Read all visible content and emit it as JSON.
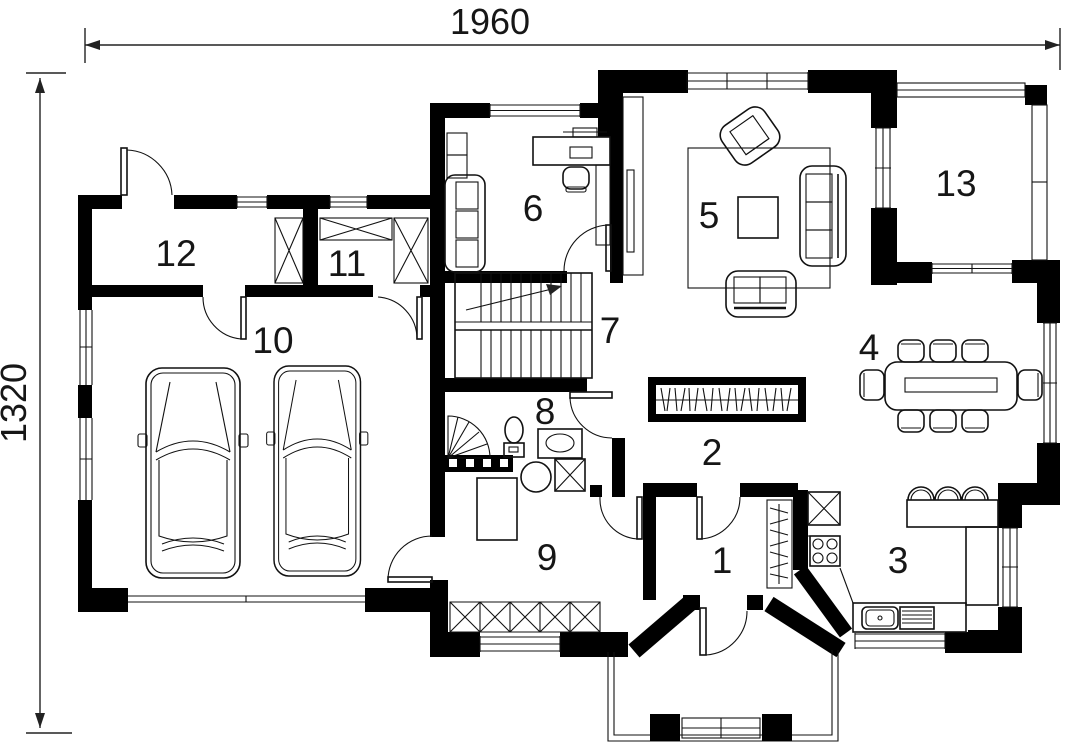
{
  "plan": {
    "dim_width": "1960",
    "dim_height": "1320",
    "rooms": [
      {
        "n": "1"
      },
      {
        "n": "2"
      },
      {
        "n": "3"
      },
      {
        "n": "4"
      },
      {
        "n": "5"
      },
      {
        "n": "6"
      },
      {
        "n": "7"
      },
      {
        "n": "8"
      },
      {
        "n": "9"
      },
      {
        "n": "10"
      },
      {
        "n": "11"
      },
      {
        "n": "12"
      },
      {
        "n": "13"
      }
    ],
    "colors": {
      "ink": "#000000",
      "paper": "#ffffff"
    }
  }
}
